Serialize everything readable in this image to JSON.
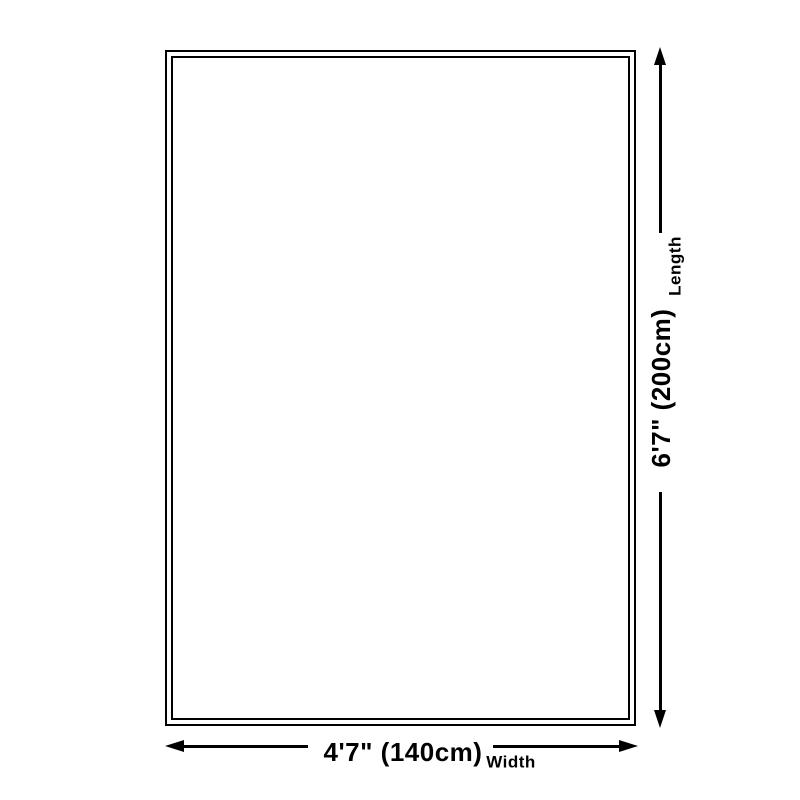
{
  "diagram": {
    "type": "product-size-diagram",
    "background_color": "#ffffff",
    "line_color": "#000000",
    "shape": "rectangle-double-border",
    "length": {
      "value": "6'7\" (200cm)",
      "label": "Length"
    },
    "width": {
      "value": "4'7\" (140cm)",
      "label": "Width"
    }
  }
}
